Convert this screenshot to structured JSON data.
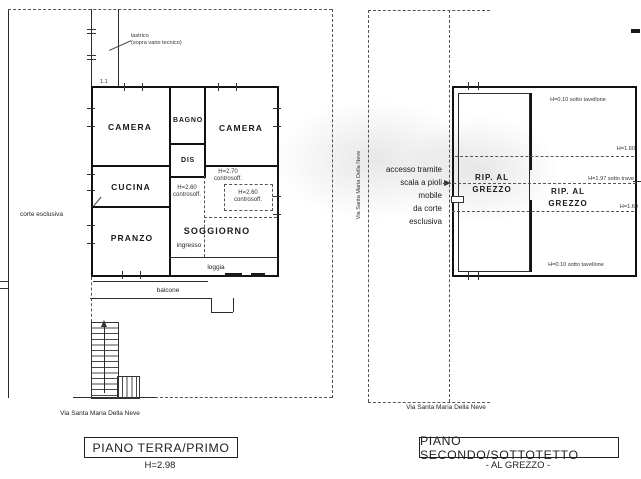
{
  "colors": {
    "ink": "#1a1a1a",
    "dash": "#555555",
    "paper": "#ffffff"
  },
  "plan_left": {
    "title": "PIANO TERRA/PRIMO",
    "height_note": "H=2.98",
    "street_label": "Via Santa Maria Della Neve",
    "court_label": "corte esclusiva",
    "roof_label_line1": "lastrico",
    "roof_label_line2": "(sopra vano tecnico)",
    "dim_label": "1.1",
    "rooms": {
      "camera1": "CAMERA",
      "bagno": "BAGNO",
      "camera2": "CAMERA",
      "dis": "DIS",
      "cucina": "CUCINA",
      "pranzo": "PRANZO",
      "soggiorno": "SOGGIORNO",
      "ingresso": "ingresso",
      "loggia": "loggia",
      "balcone": "balcone"
    },
    "ceiling_notes": {
      "n1_h": "H=2.70",
      "n1_t": "controsoff.",
      "n2_h": "H=2.60",
      "n2_t": "controsoff.",
      "n3_h": "H=2.60",
      "n3_t": "controsoff."
    }
  },
  "plan_right": {
    "title": "PIANO SECONDO/SOTTOTETTO",
    "subtitle": "- AL GREZZO -",
    "street_label_vertical": "Via Santa Maria Della Neve",
    "street_label_bottom": "Via Santa Maria Della Neve",
    "access_note": {
      "l1": "accesso tramite",
      "l2": "scala a pioli",
      "l3": "mobile",
      "l4": "da corte",
      "l5": "esclusiva"
    },
    "rooms": {
      "rip1_l1": "RIP. AL",
      "rip1_l2": "GREZZO",
      "rip2_l1": "RIP. AL",
      "rip2_l2": "GREZZO"
    },
    "height_notes": {
      "top": "H=0.10 sotto tavellone",
      "bottom": "H=0.10 sotto tavellone",
      "h160_top": "H=1.60",
      "h160_bottom": "H=1.60",
      "h197": "H=1.97 sotto trave"
    }
  }
}
